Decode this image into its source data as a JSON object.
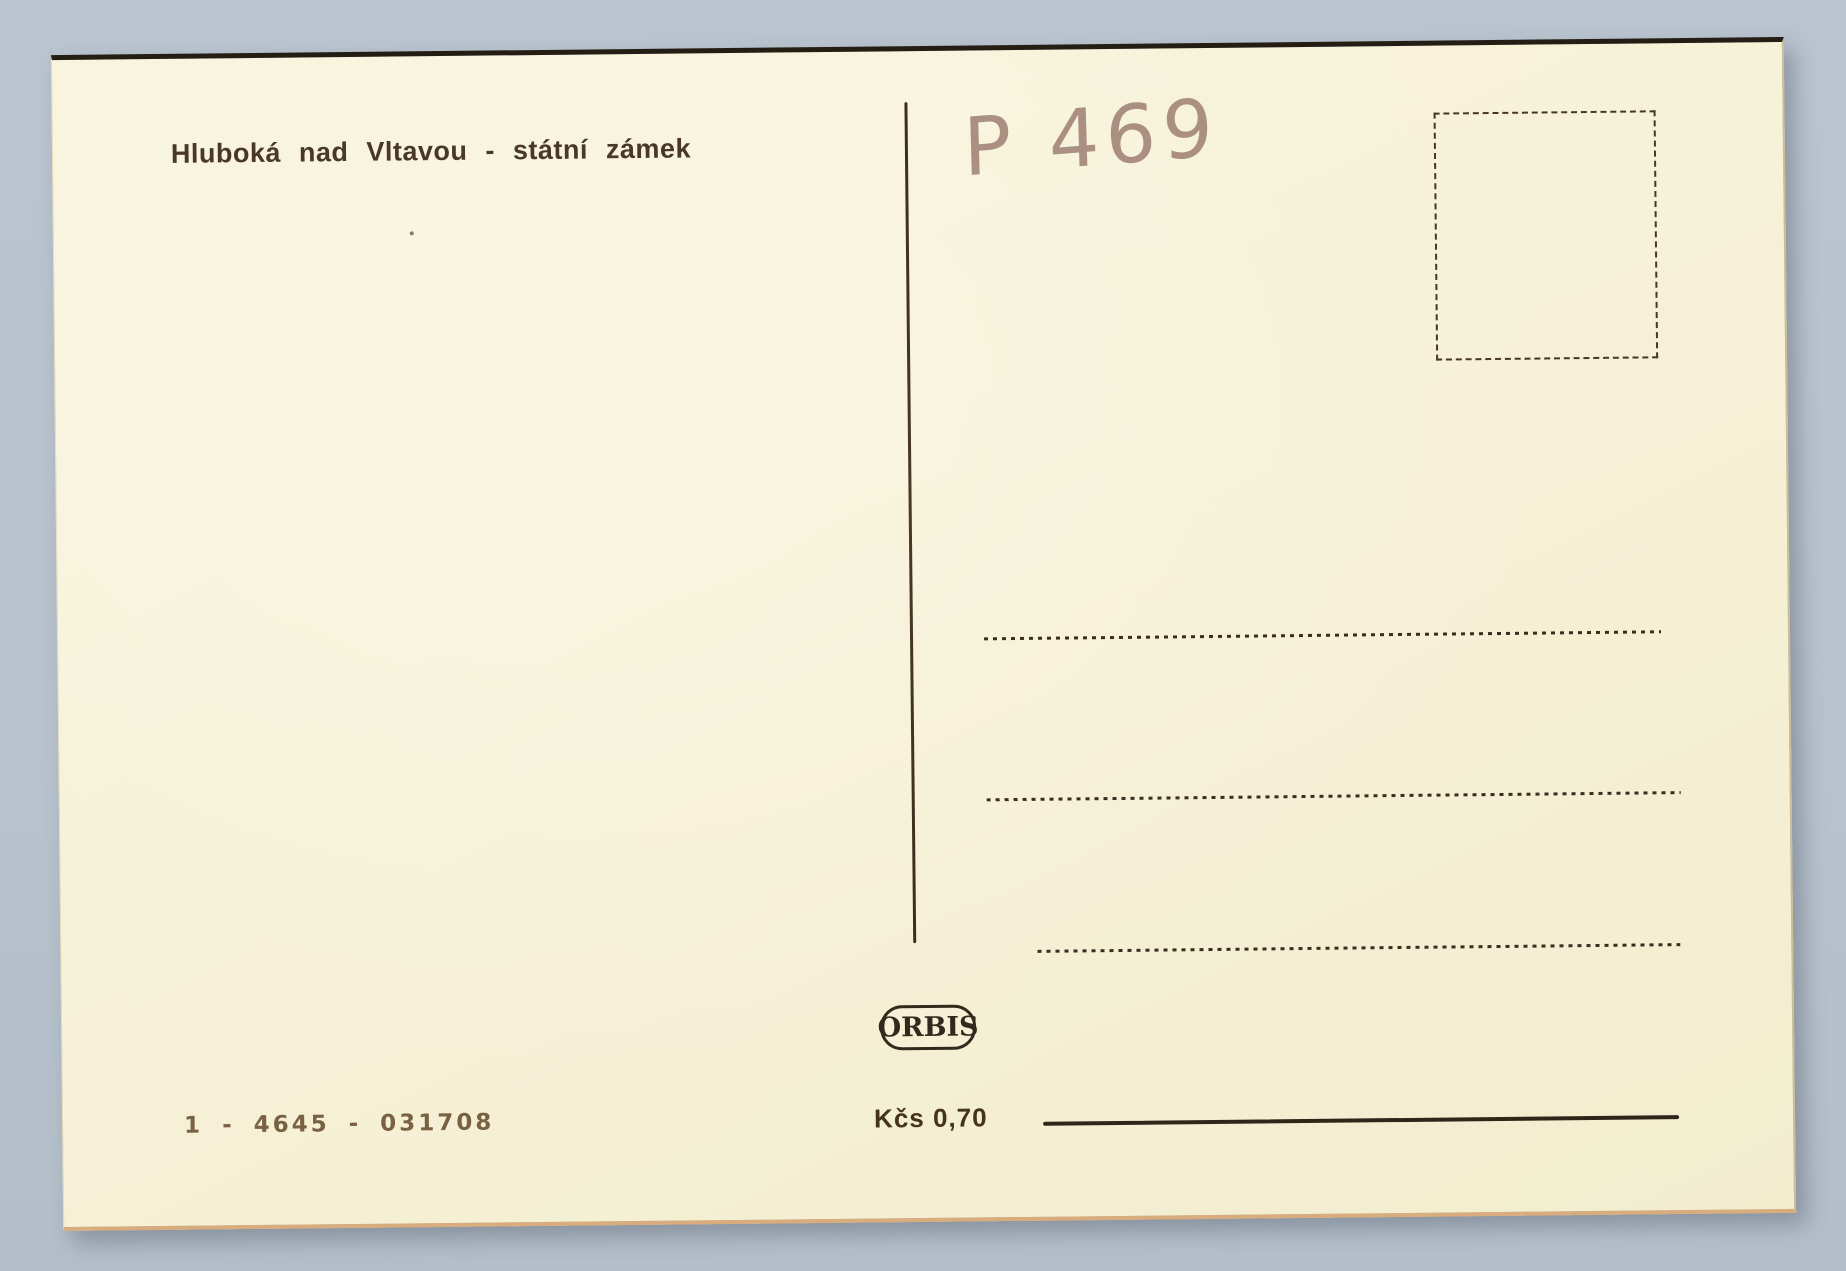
{
  "scan": {
    "background_color": "#b9c3ce"
  },
  "postcard": {
    "paper_color": "#f6f1d6",
    "ink_color": "#4a3827",
    "title": "Hluboká nad Vltavou - státní zámek",
    "handwritten_note": "P 469",
    "handwriting_color": "#a5887b",
    "address_lines_count": 3,
    "publisher": {
      "logo_text": "ORBIS"
    },
    "catalog_number": "1 - 4645 - 031708",
    "price": "Kčs 0,70"
  }
}
